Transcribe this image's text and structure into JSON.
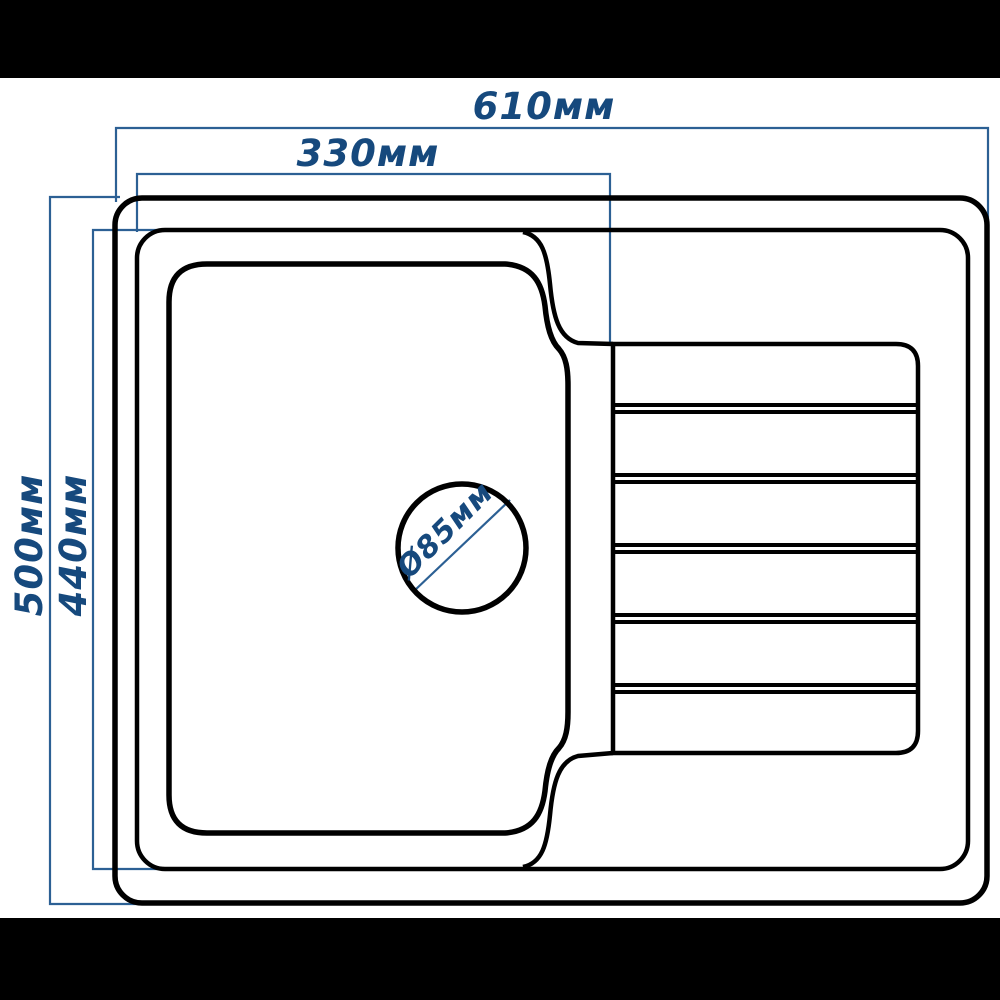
{
  "diagram": {
    "title": "sink-top-view-dimension-drawing",
    "labels": {
      "overall_width": "610мм",
      "bowl_width": "330мм",
      "overall_depth": "500мм",
      "inner_depth": "440мм",
      "drain_diameter": "Ø85мм"
    },
    "measurements": [
      {
        "name": "overall width",
        "value": 610,
        "unit": "мм"
      },
      {
        "name": "bowl section width",
        "value": 330,
        "unit": "мм"
      },
      {
        "name": "overall depth",
        "value": 500,
        "unit": "мм"
      },
      {
        "name": "inner rim depth",
        "value": 440,
        "unit": "мм"
      },
      {
        "name": "drain hole diameter",
        "value": 85,
        "unit": "мм"
      }
    ],
    "features": {
      "bowl": "rounded rectangular bowl on left",
      "drain": "circular drain hole in bowl",
      "drainboard": "ribbed drainboard panel on right with 5 double-line ridges"
    },
    "colors": {
      "outline": "#000000",
      "dimension_line": "#2c6094",
      "dimension_text": "#16497d",
      "background": "#ffffff",
      "letterbox": "#000000"
    }
  }
}
